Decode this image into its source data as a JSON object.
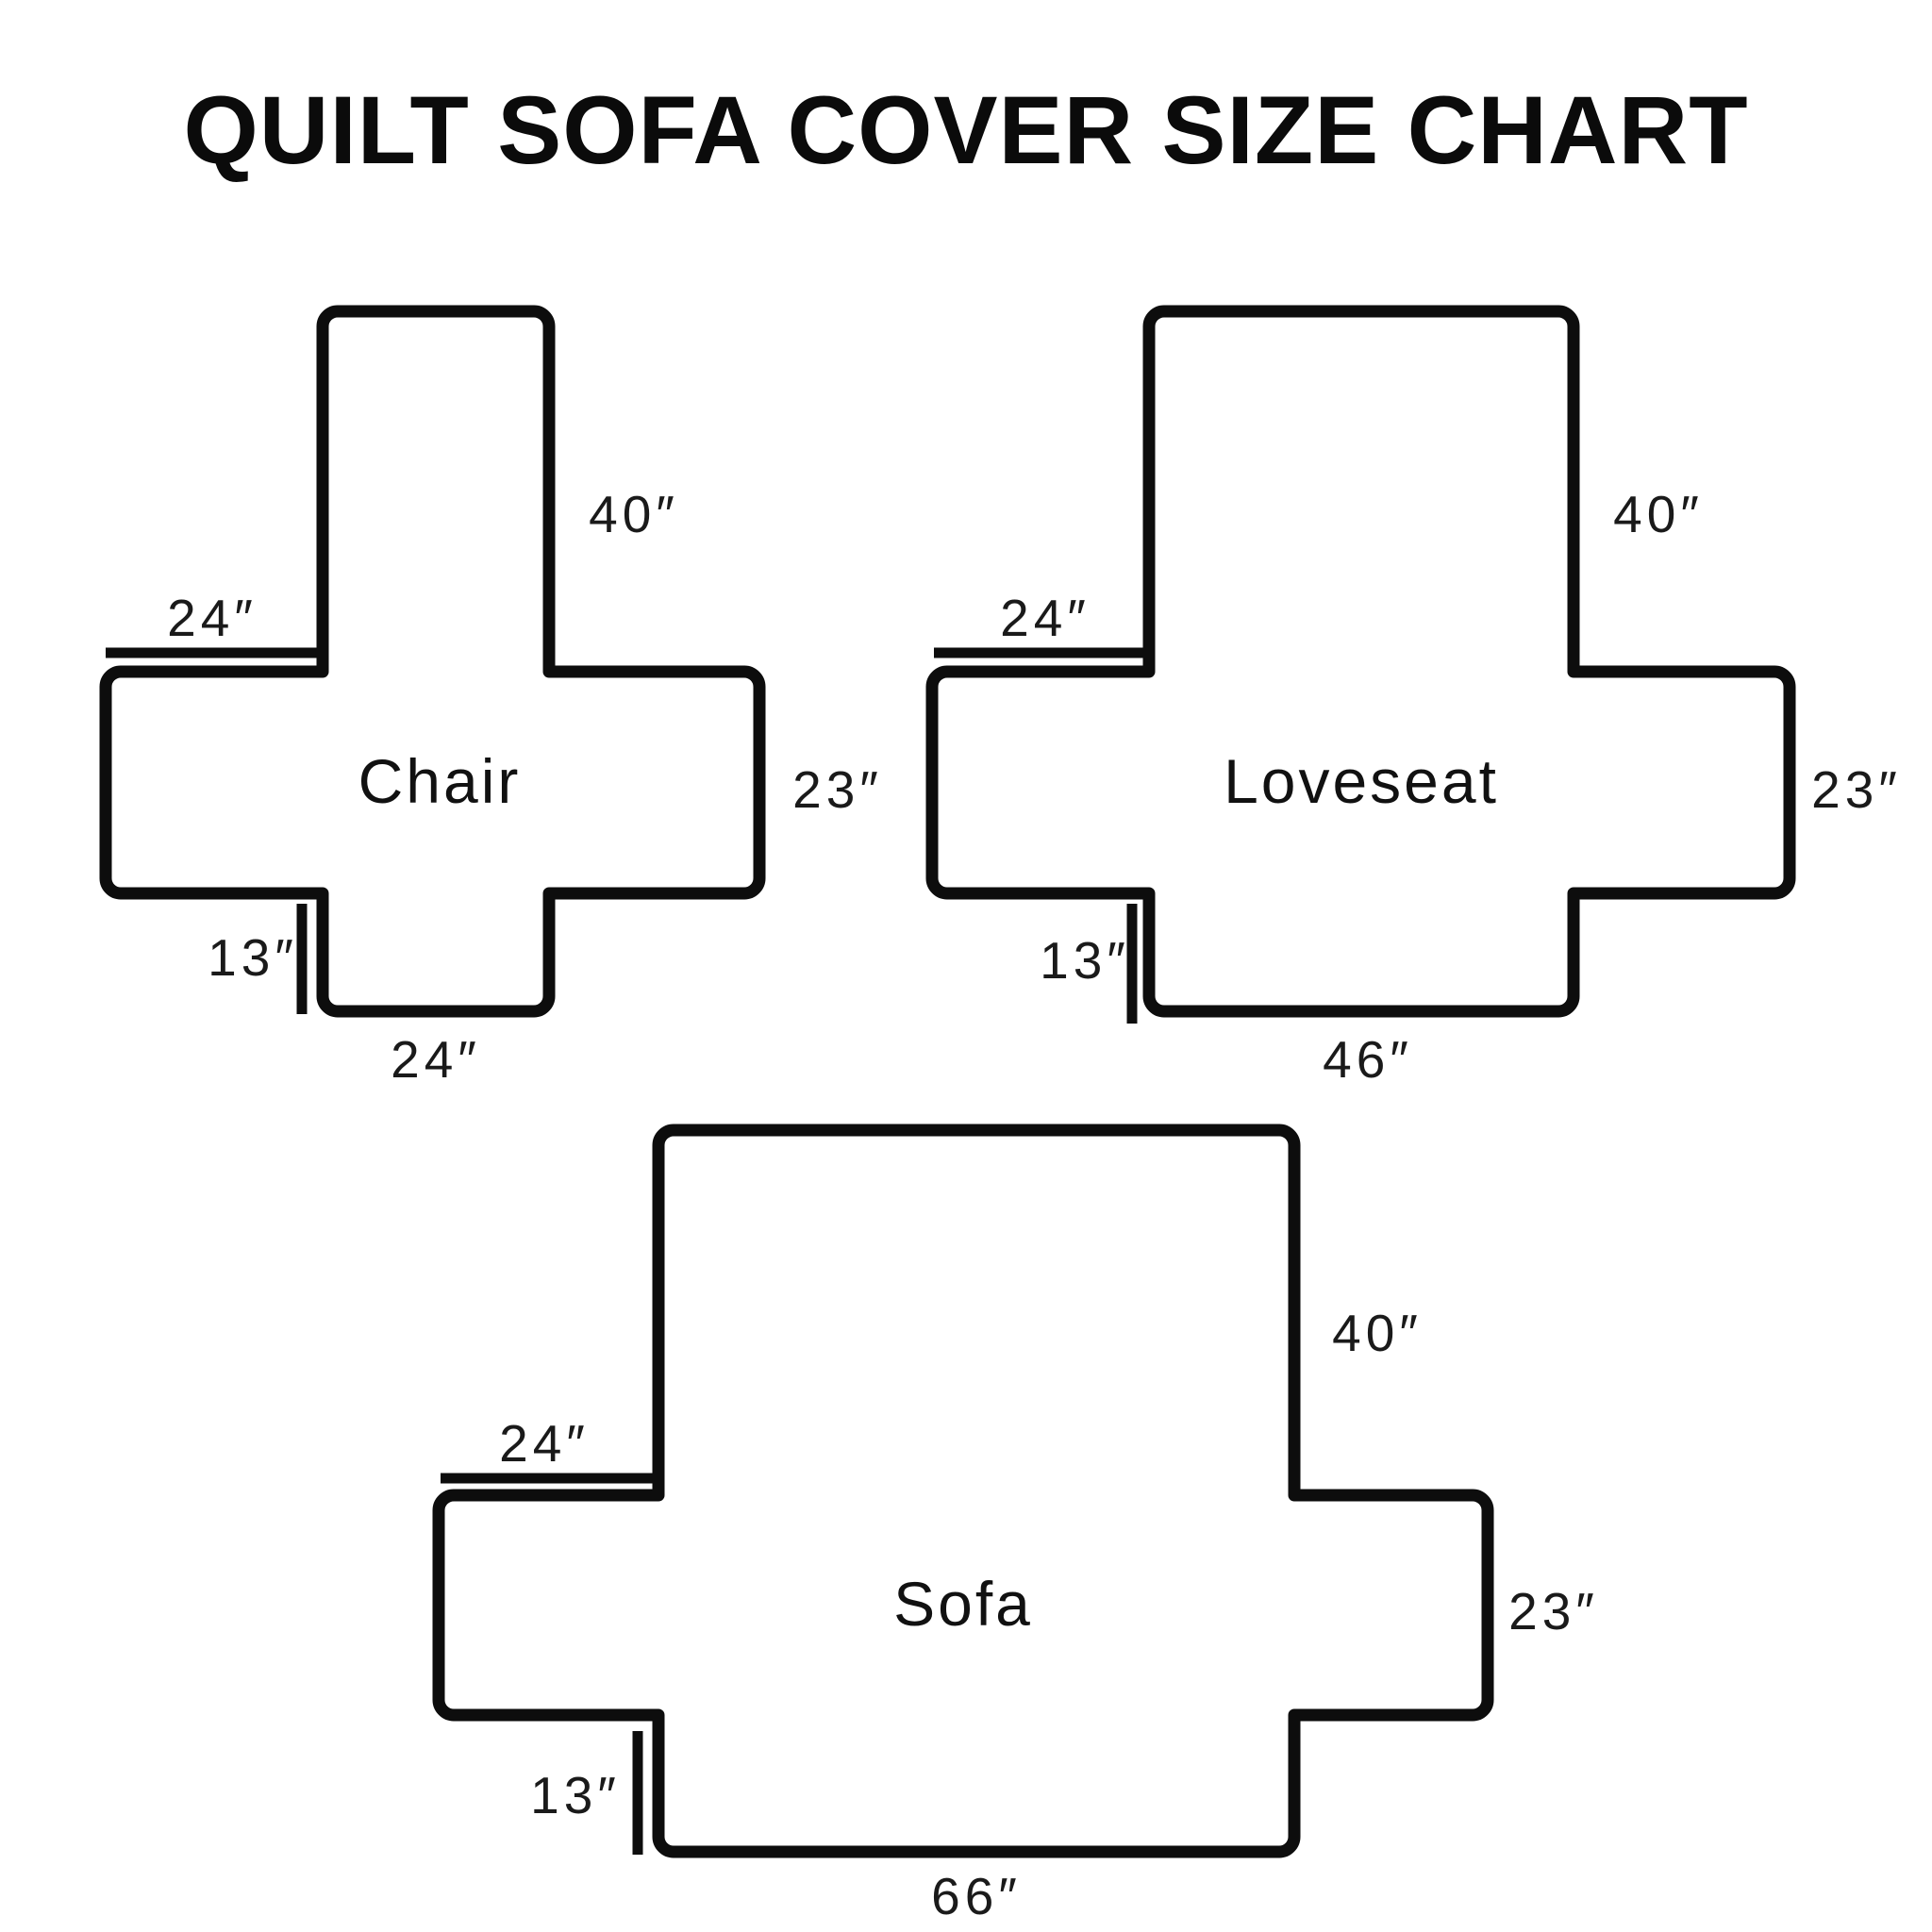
{
  "title": "QUILT SOFA COVER SIZE CHART",
  "colors": {
    "line": "#0d0d0d",
    "background": "#ffffff",
    "text": "#1a1a1a"
  },
  "diagrams": [
    {
      "name": "Chair",
      "dims": {
        "arm_top_width": "24″",
        "back_height": "40″",
        "side_depth": "23″",
        "skirt_height": "13″",
        "bottom_width": "24″"
      }
    },
    {
      "name": "Loveseat",
      "dims": {
        "arm_top_width": "24″",
        "back_height": "40″",
        "side_depth": "23″",
        "skirt_height": "13″",
        "bottom_width": "46″"
      }
    },
    {
      "name": "Sofa",
      "dims": {
        "arm_top_width": "24″",
        "back_height": "40″",
        "side_depth": "23″",
        "skirt_height": "13″",
        "bottom_width": "66″"
      }
    }
  ]
}
